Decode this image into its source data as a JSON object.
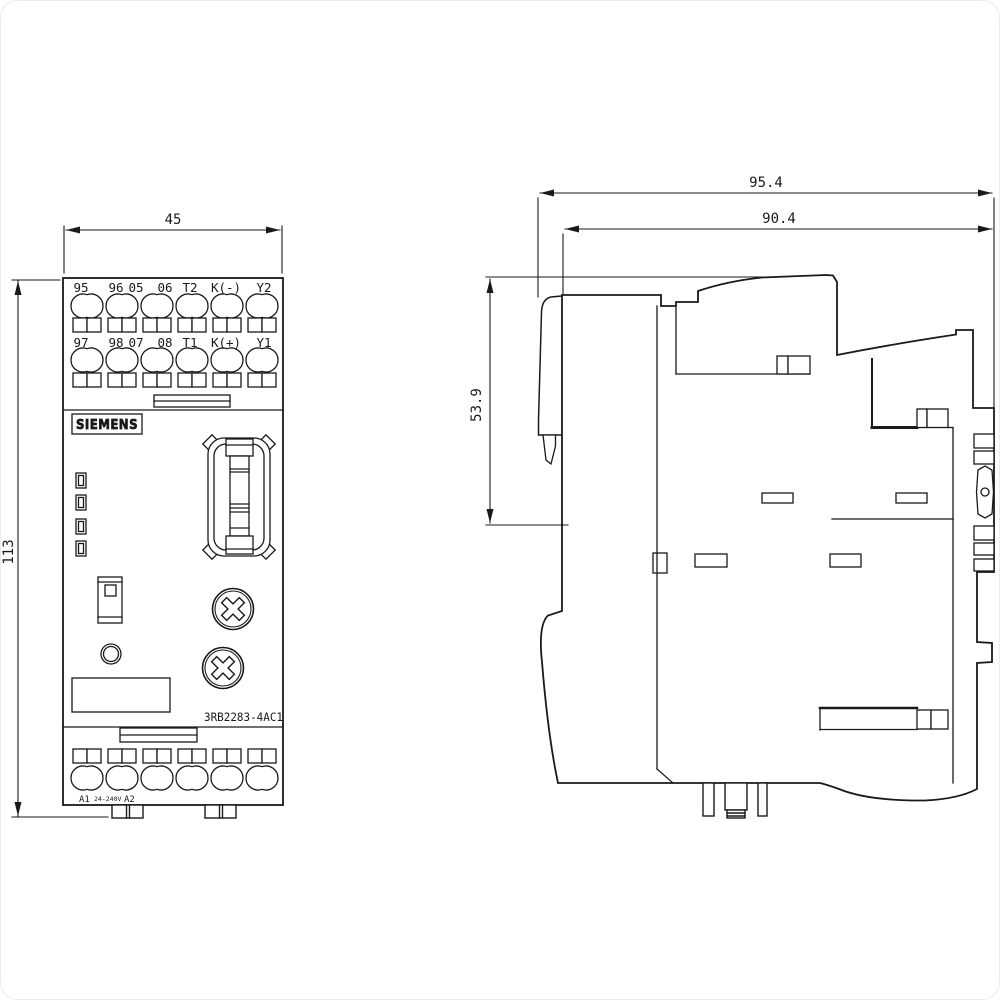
{
  "drawing": {
    "front_view": {
      "dim_width": "45",
      "dim_height": "113",
      "terminal_row_top": [
        "95",
        "96",
        "05",
        "06",
        "T2",
        "K(-)",
        "Y2"
      ],
      "terminal_row_mid": [
        "97",
        "98",
        "07",
        "08",
        "T1",
        "K(+)",
        "Y1"
      ],
      "brand": "SIEMENS",
      "part_number": "3RB2283-4AC1",
      "supply": {
        "a1": "A1",
        "range": "24-240V",
        "a2": "A2"
      }
    },
    "side_view": {
      "dim_depth_total": "95.4",
      "dim_depth_body": "90.4",
      "dim_height_upper": "53.9"
    },
    "line_color": "#1a1a1a"
  }
}
